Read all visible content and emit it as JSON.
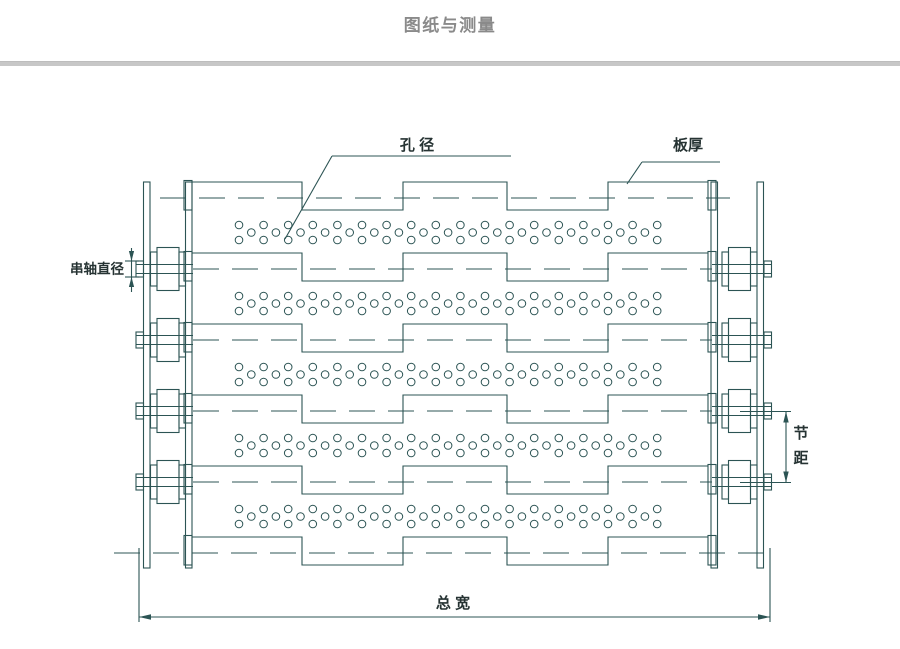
{
  "header": {
    "title": "图纸与测量"
  },
  "labels": {
    "hole_diameter": "孔 径",
    "plate_thickness": "板厚",
    "shaft_diameter": "串轴直径",
    "pitch_line1": "节",
    "pitch_line2": "距",
    "total_width": "总 宽"
  },
  "colors": {
    "line": "#2c5454",
    "label_text": "#263333",
    "title_text": "#8a8a8a",
    "divider": "#c7c7c7",
    "background": "#ffffff"
  },
  "diagram": {
    "dashPattern": "26 13",
    "plate": {
      "left": 192,
      "right": 708,
      "topOffset": -16,
      "botOffset": 12,
      "steps": [
        302,
        403,
        507,
        608
      ],
      "lipLeft": 184,
      "lipRight": 708,
      "lipWidth": 8,
      "lipTopDy": -17.5,
      "lipH": 29.5
    },
    "hinges": [
      {
        "y": 198,
        "dash": [
          160,
          730
        ],
        "pin": false
      },
      {
        "y": 269,
        "dash": [
          193,
          712
        ],
        "pin": true
      },
      {
        "y": 340,
        "dash": [
          193,
          712
        ],
        "pin": true
      },
      {
        "y": 411,
        "dash": [
          193,
          712
        ],
        "pin": true
      },
      {
        "y": 482,
        "dash": [
          193,
          712
        ],
        "pin": true
      },
      {
        "y": 553,
        "dash": [
          114,
          766
        ],
        "pin": false
      }
    ],
    "holes": {
      "xStart": 239,
      "period": 24.6,
      "pairs": 18,
      "r": 3.8,
      "topDy": 27,
      "midDy": 34.5,
      "botDy": 42,
      "slats": 5
    },
    "chain": {
      "stripY": [
        182,
        568
      ],
      "rollerHalfH": 21.5,
      "bushHalfH": 17,
      "capHalfH": 8,
      "pinHalfGap": 4.5,
      "rollerHinges": [
        1,
        2,
        3,
        4
      ],
      "left": {
        "strips": [
          [
            143.5,
            150
          ],
          [
            185.5,
            192
          ]
        ],
        "bush": [
          [
            150.5,
            157
          ],
          [
            179,
            185.5
          ]
        ],
        "roller": [
          157,
          179
        ],
        "cap": [
          136,
          143.5
        ],
        "pin": [
          136,
          193
        ]
      },
      "right": {
        "strips": [
          [
            711,
            717.5
          ],
          [
            757,
            763.5
          ]
        ],
        "bush": [
          [
            722,
            728.5
          ],
          [
            750.5,
            757
          ]
        ],
        "roller": [
          728.5,
          750.5
        ],
        "cap": [
          764,
          771.5
        ],
        "pin": [
          712,
          771.5
        ]
      }
    },
    "dims": {
      "shaft": {
        "x": 131.5,
        "lineY": [
          248,
          292
        ],
        "ticksY": [
          261,
          277
        ],
        "tickX": [
          125,
          139
        ]
      },
      "pitch": {
        "x": 786,
        "y": [
          411.5,
          482.5
        ],
        "extX": [
          740,
          791
        ]
      },
      "width": {
        "y": 617,
        "x": [
          139,
          770
        ],
        "extTopY": 548,
        "extBotY": 622
      }
    },
    "leaders": {
      "hole": {
        "bar": [
          332,
          511,
          156
        ],
        "tip": [
          285,
          239
        ]
      },
      "plate": {
        "bar": [
          642,
          720,
          162
        ],
        "tip": [
          627,
          184
        ]
      }
    }
  }
}
